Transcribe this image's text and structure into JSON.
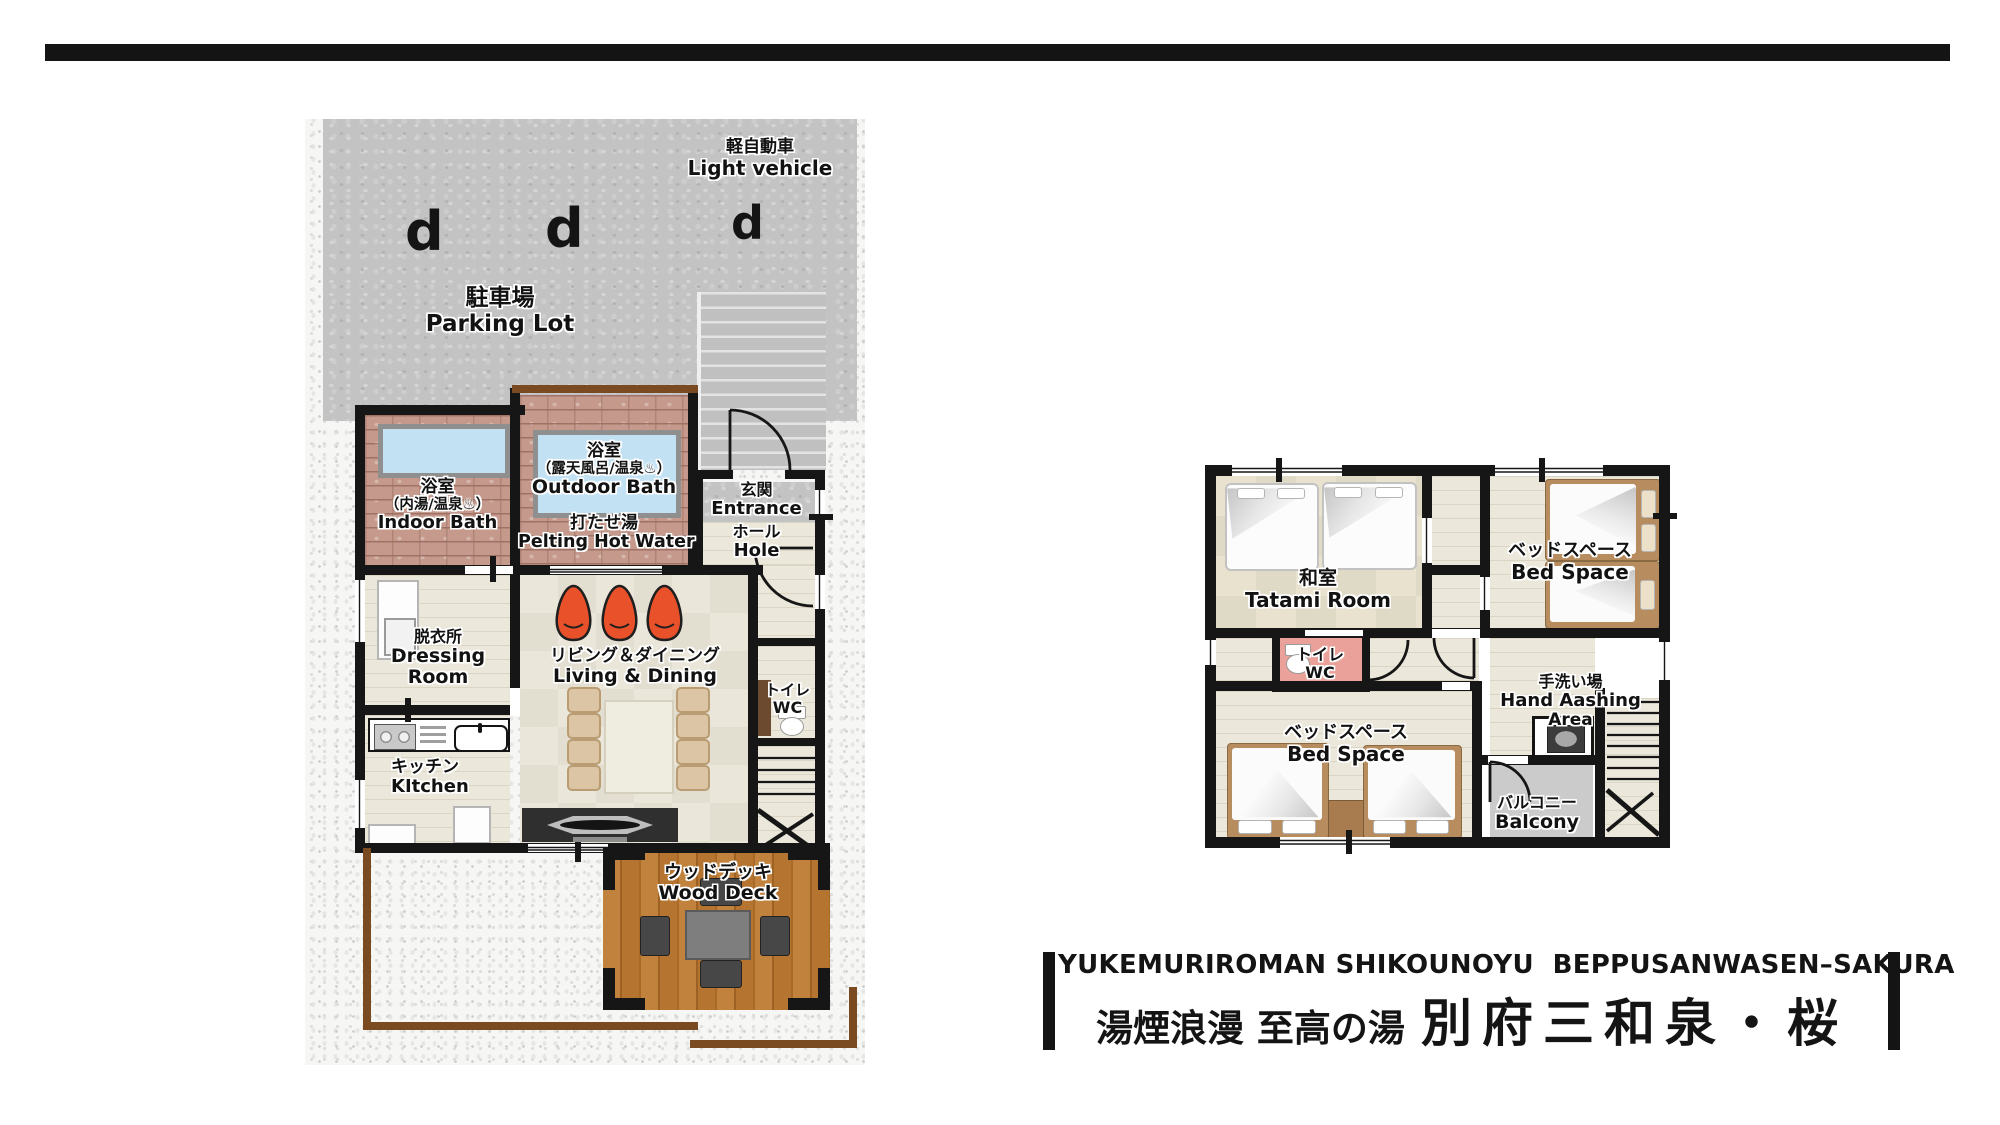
{
  "floor1": {
    "parking": {
      "vehicle_jp": "軽自動車",
      "vehicle_en": "Light vehicle",
      "name_jp": "駐車場",
      "name_en": "Parking Lot",
      "car_glyph": "d"
    },
    "indoor_bath": {
      "jp": "浴室",
      "jp_detail": "（内湯/温泉♨）",
      "en": "Indoor Bath"
    },
    "outdoor_bath": {
      "jp": "浴室",
      "jp_detail": "（露天風呂/温泉♨）",
      "en": "Outdoor Bath"
    },
    "pelting": {
      "jp": "打たせ湯",
      "en": "Pelting Hot Water"
    },
    "entrance": {
      "jp": "玄関",
      "en": "Entrance"
    },
    "hall": {
      "jp": "ホール",
      "en": "Hole"
    },
    "dressing_room": {
      "jp": "脱衣所",
      "en_line1": "Dressing",
      "en_line2": "Room"
    },
    "living_dining": {
      "jp": "リビング＆ダイニング",
      "en": "Living & Dining"
    },
    "toilet": {
      "jp": "トイレ",
      "en": "WC"
    },
    "kitchen": {
      "jp": "キッチン",
      "en": "KItchen"
    },
    "wood_deck": {
      "jp": "ウッドデッキ",
      "en": "Wood Deck"
    }
  },
  "floor2": {
    "tatami": {
      "jp": "和室",
      "en": "Tatami Room"
    },
    "bed_space_upper": {
      "jp": "ベッドスペース",
      "en": "Bed Space"
    },
    "toilet": {
      "jp": "トイレ",
      "en": "WC"
    },
    "hand_washing": {
      "jp": "手洗い場",
      "en_line1": "Hand Aashing",
      "en_line2": "Area"
    },
    "bed_space_lower": {
      "jp": "ベッドスペース",
      "en": "Bed Space"
    },
    "balcony": {
      "jp": "バルコニー",
      "en": "Balcony"
    }
  },
  "footer": {
    "title_en": "YUKEMURIROMAN SHIKOUNOYU  BEPPUSANWASEN–SAKURA",
    "title_jp_prefix": "湯煙浪漫 至高の湯",
    "title_jp_main": "別府三和泉・桜"
  },
  "colors": {
    "wall": "#161616",
    "bath_water": "#c2e2f4",
    "beanbag_orange": "#e8512a",
    "deck_brown": "#b5742f",
    "fence_brown": "#7a4a21",
    "wc_pink": "#e9a19a"
  }
}
